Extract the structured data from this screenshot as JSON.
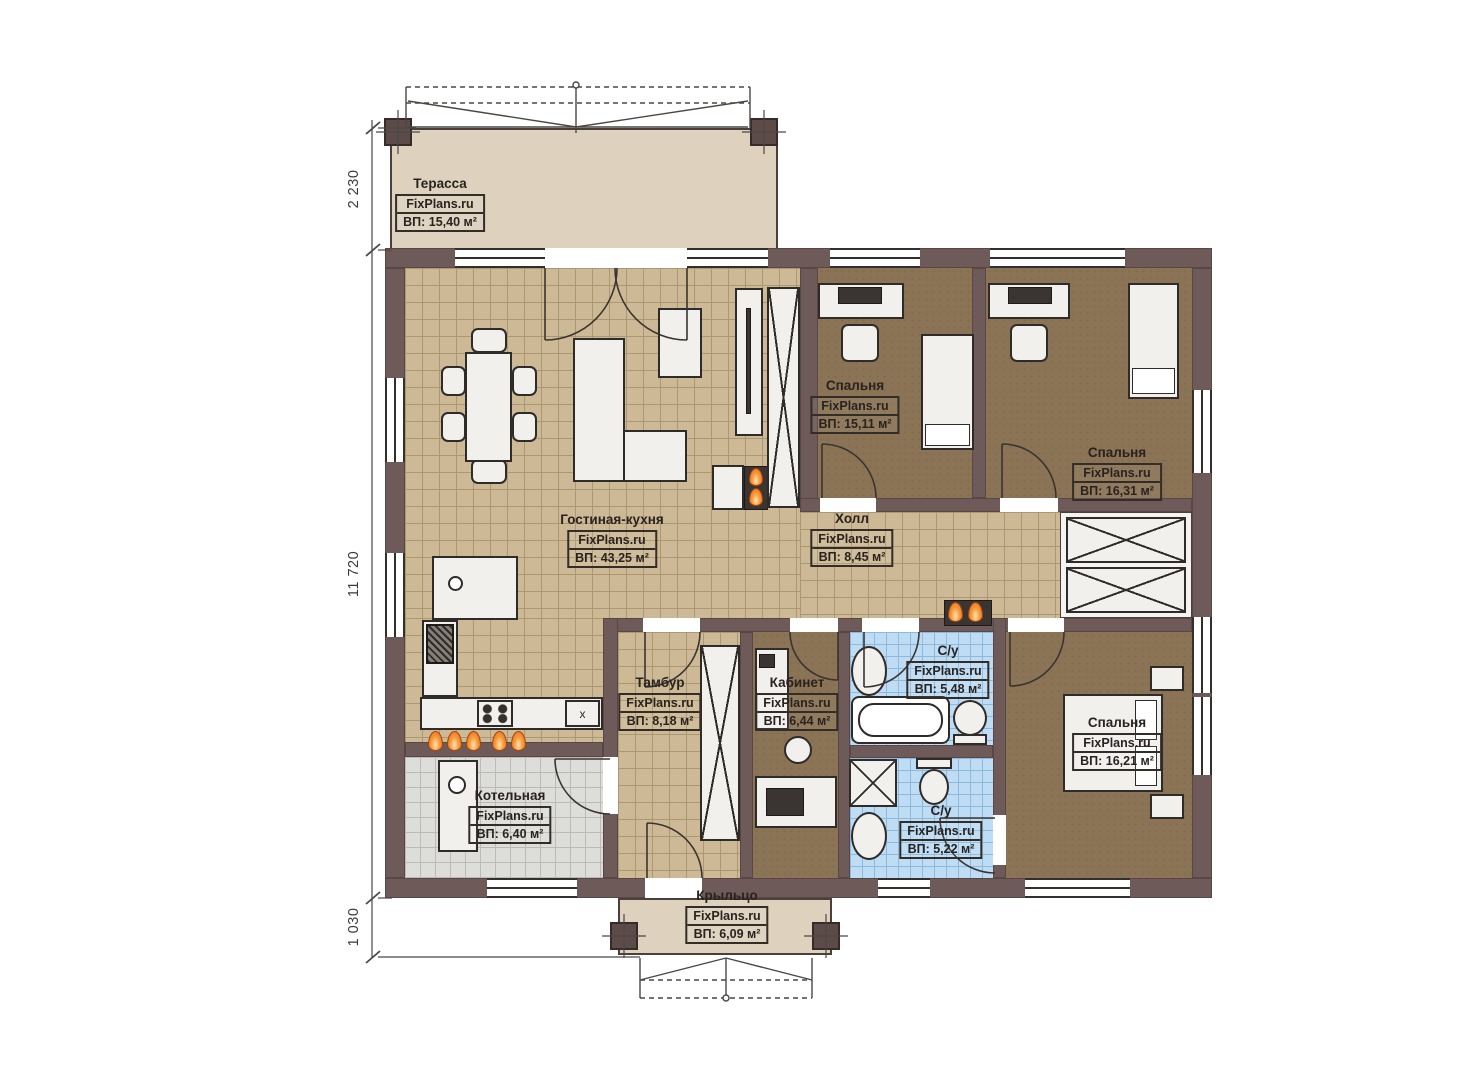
{
  "plan": {
    "branding": "FixPlans.ru",
    "dimensions": {
      "terrace_depth": "2 230",
      "house_depth": "11 720",
      "porch_depth": "1 030"
    },
    "marks": {
      "kitchen_box": "x"
    },
    "rooms": {
      "terrace": {
        "name": "Терасса",
        "brand": "FixPlans.ru",
        "area": "ВП: 15,40 м²"
      },
      "living": {
        "name": "Гостиная-кухня",
        "brand": "FixPlans.ru",
        "area": "ВП: 43,25 м²"
      },
      "hall": {
        "name": "Холл",
        "brand": "FixPlans.ru",
        "area": "ВП: 8,45 м²"
      },
      "bedroom1": {
        "name": "Спальня",
        "brand": "FixPlans.ru",
        "area": "ВП: 15,11 м²"
      },
      "bedroom2": {
        "name": "Спальня",
        "brand": "FixPlans.ru",
        "area": "ВП: 16,31 м²"
      },
      "bedroom3": {
        "name": "Спальня",
        "brand": "FixPlans.ru",
        "area": "ВП: 16,21 м²"
      },
      "tambour": {
        "name": "Тамбур",
        "brand": "FixPlans.ru",
        "area": "ВП: 8,18 м²"
      },
      "office": {
        "name": "Кабинет",
        "brand": "FixPlans.ru",
        "area": "ВП: 6,44 м²"
      },
      "bath1": {
        "name": "С/у",
        "brand": "FixPlans.ru",
        "area": "ВП: 5,48 м²"
      },
      "bath2": {
        "name": "С/у",
        "brand": "FixPlans.ru",
        "area": "ВП: 5,22 м²"
      },
      "boiler": {
        "name": "Котельная",
        "brand": "FixPlans.ru",
        "area": "ВП: 6,40 м²"
      },
      "porch": {
        "name": "Крыльцо",
        "brand": "FixPlans.ru",
        "area": "ВП: 6,09 м²"
      }
    },
    "colors": {
      "wall": "#6e5b59",
      "tile_beige": "#cdb995",
      "tile_blue": "#bedcf4",
      "tile_grey": "#ddddda",
      "floor_brown": "#8b7356",
      "floor_plain_beige": "#ded2bf",
      "flame_orange": "#e8731e",
      "line_dark": "#32302c"
    }
  }
}
